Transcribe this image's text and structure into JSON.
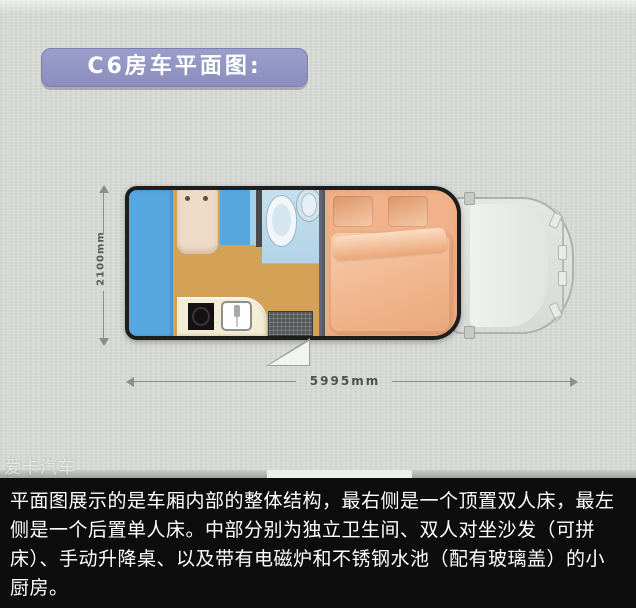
{
  "header": {
    "title": "C6房车平面图:"
  },
  "floorplan": {
    "height_label": "2100mm",
    "width_label": "5995mm"
  },
  "watermark": "爱卡汽车",
  "caption": "平面图展示的是车厢内部的整体结构，最右侧是一个顶置双人床，最左侧是一个后置单人床。中部分别为独立卫生间、双人对坐沙发（可拼床）、手动升降桌、以及带有电磁炉和不锈钢水池（配有玻璃盖）的小厨房。",
  "colors": {
    "badge_purple": "#9295c5",
    "outline_black": "#1d1d1d",
    "sofa_blue": "#56a6e0",
    "floor_tan": "#d3a257",
    "bed_salmon": "#f1b28b",
    "counter_cream": "#f4edd6",
    "bathroom_blue": "#bcd9e8",
    "photo_background": "#d6d9d4",
    "caption_background": "#0d0d0d"
  }
}
